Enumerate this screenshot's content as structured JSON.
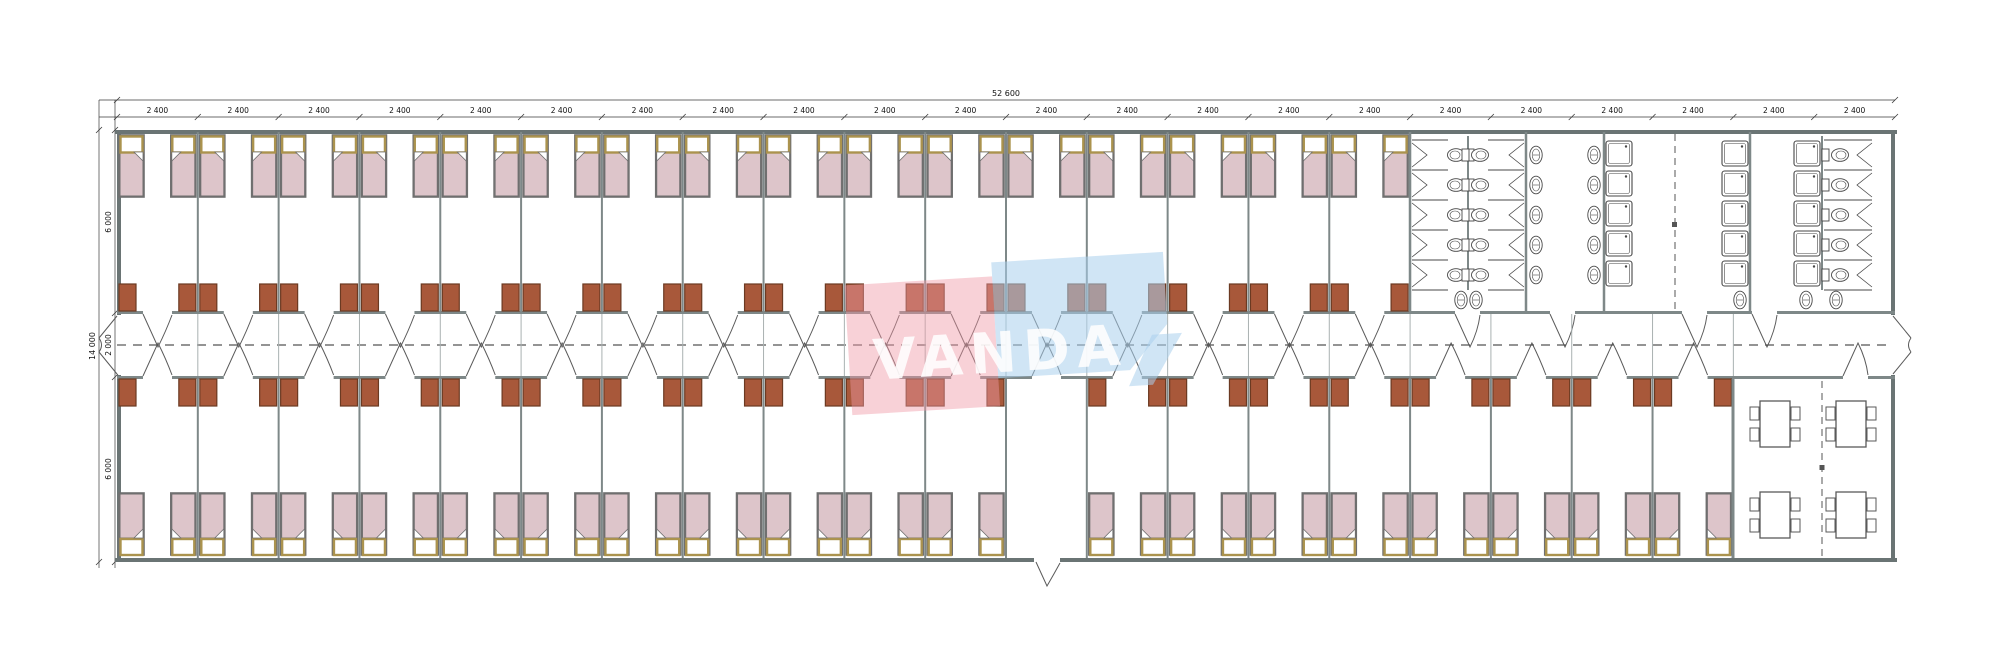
{
  "watermark": {
    "text": "VANDA",
    "pink_color": "#ef9aa6",
    "blue_color": "#a9cfec",
    "text_color": "#ffffff"
  },
  "dimensions": {
    "overall_length": "52 600",
    "bay_label": "2 400",
    "bay_count": 22,
    "overall_width": "14 000",
    "width_segments": [
      "6 000",
      "2 000",
      "6 000"
    ]
  },
  "colors": {
    "paper": "#ffffff",
    "wall": "#6a7474",
    "partition": "#7e8888",
    "light_partition": "#a9b1b1",
    "dim_line": "#3a3a3a",
    "dim_text": "#111111",
    "fixture": "#474747",
    "door": "#5a5a5a",
    "bed_fill": "#ddc5ca",
    "bed_outline": "#6f6f6f",
    "headboard": "#ab934e",
    "pillow": "#ffffff",
    "wardrobe_fill": "#a8583a",
    "wardrobe_outline": "#6b3a22",
    "dash": "#555555"
  },
  "layout": {
    "top_bedroom_bays": 16,
    "bottom_bedroom_bays": 20,
    "vestibule_bay_index": 11,
    "beds_per_room": 2,
    "wardrobes_per_room": 2,
    "toilet_stall_rows": 5,
    "back_to_back_toilet_columns": 2,
    "wash_basin_columns": 2,
    "basin_rows": 5,
    "shower_columns": 3,
    "shower_rows": 5,
    "end_toilet_stalls": 5,
    "dining_tables": 4,
    "chairs_per_table": 4
  }
}
